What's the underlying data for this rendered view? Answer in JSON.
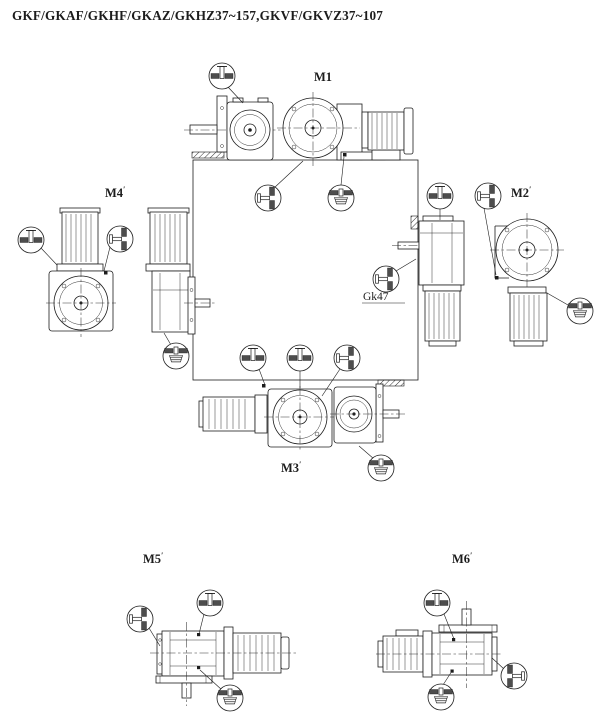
{
  "title": "GKF/GKAF/GKHF/GKAZ/GKHZ37~157,GKVF/GKVZ37~107",
  "mounting_positions": {
    "m1": {
      "label": "M1",
      "sup": ""
    },
    "m2": {
      "label": "M2",
      "sup": "′"
    },
    "m3": {
      "label": "M3",
      "sup": "′"
    },
    "m4": {
      "label": "M4",
      "sup": "′"
    },
    "m5": {
      "label": "M5",
      "sup": "′"
    },
    "m6": {
      "label": "M6",
      "sup": "′"
    }
  },
  "callouts": {
    "gk47": {
      "label": "Gk47"
    }
  },
  "plug_symbols": {
    "vent": "breather-vent-plug",
    "level": "oil-level-plug",
    "drain": "oil-drain-plug"
  },
  "colors": {
    "line": "#1c1c1c",
    "fill_dark": "#4d4d4d",
    "background": "#ffffff"
  }
}
